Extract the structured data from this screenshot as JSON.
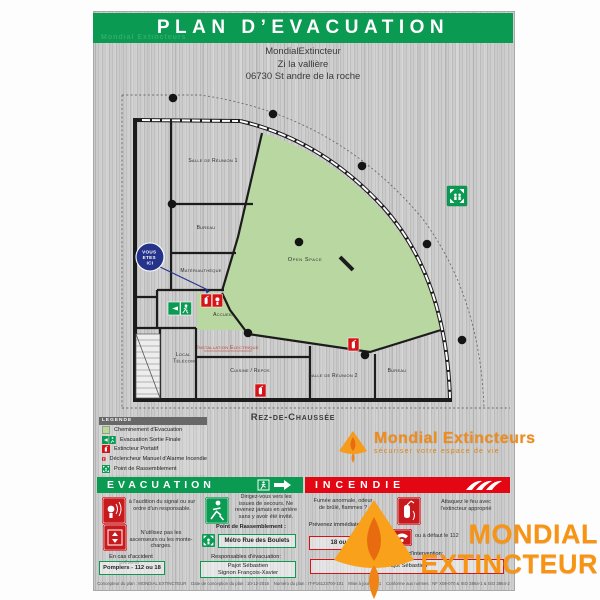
{
  "poster": {
    "title": "PLAN D’EVACUATION",
    "address_line1": "MondialExtincteur",
    "address_line2": "Zi la vallière",
    "address_line3": "06730 St andre de la roche",
    "floor_label": "Rez-de-Chaussée"
  },
  "plan": {
    "you_are_here_1": "VOUS",
    "you_are_here_2": "ETES",
    "you_are_here_3": "ICI",
    "rooms": {
      "salle_reunion_1": "Salle de Réunion 1",
      "bureau_1": "Bureau",
      "materiautheque": "Matériauthèque",
      "accueil": "Accueil",
      "local_telecom_1": "Local",
      "local_telecom_2": "Télécom",
      "installation_electrique": "Installation Electrique",
      "cuisine_repos": "Cuisine / Repos",
      "salle_reunion_2": "Salle de Réunion 2",
      "bureau_2": "Bureau",
      "open_space": "Open Space"
    }
  },
  "legend": {
    "header": "LEGENDE",
    "items": [
      {
        "icon": "evacuation-path-swatch",
        "label": "Cheminement d'Evacuation"
      },
      {
        "icon": "exit-sign-icon",
        "label": "Evacuation Sortie Finale"
      },
      {
        "icon": "extinguisher-icon",
        "label": "Extincteur Portatif"
      },
      {
        "icon": "manual-alarm-icon",
        "label": "Déclencheur Manuel d'Alarme Incendie"
      },
      {
        "icon": "assembly-point-icon",
        "label": "Point de Rassemblement"
      }
    ]
  },
  "brand": {
    "name": "Mondial Extincteurs",
    "tagline": "sécuriser votre espace de vie"
  },
  "evacuation": {
    "header": "EVACUATION",
    "item1": "à l'audition du signal ou sur ordre d'un responsable.",
    "item2": "Dirigez-vous vers les issues de secours. Ne revenez jamais en arrière sans y avoir été invité.",
    "item3": "N'utilisez pas les ascenseurs ou les monte-charges.",
    "assembly_label": "Point de Rassemblement :",
    "assembly_value": "Métro Rue des Boulets",
    "accident_label": "En cas d'accident prévenir :",
    "accident_value": "Pompiers - 112 ou 18",
    "resp_label": "Responsables d'évacuation:",
    "resp_line1": "Pajot Sébastien",
    "resp_line2": "Signon François-Xavier"
  },
  "incendie": {
    "header": "INCENDIE",
    "item1": "Fumée anormale, odeur de brûlé, flammes ?",
    "alert_label": "Prévenez immédiatement :",
    "alert_value": "18 ou 112",
    "item2": "Attaquez le feu avec l'extincteur approprié",
    "item3": "ou à défaut le 112",
    "resp_label": "Responsables d'intervention:",
    "resp_line1": "Pajot Sébastien"
  },
  "watermark": {
    "line1": "MONDIAL",
    "line2": "EXTINCTEUR"
  },
  "footer": {
    "text": "Concepteur du plan : MONDIAL EXTINCTEUR    Date de conception du plan : 10-12-2016    Numéro du plan : IT-P16123700-101    Mise à jour N° : 1    Conforme aux normes : NF X08-070 & ISO 3864-1 & ISO 3864-2"
  },
  "colors": {
    "safety_green": "#0a9a52",
    "safety_red": "#e30613",
    "evacuation_path_green": "#b9d7a0",
    "you_are_here_blue": "#26338b",
    "brand_orange": "#f79414",
    "metal_gray": "#c7c7c7"
  }
}
